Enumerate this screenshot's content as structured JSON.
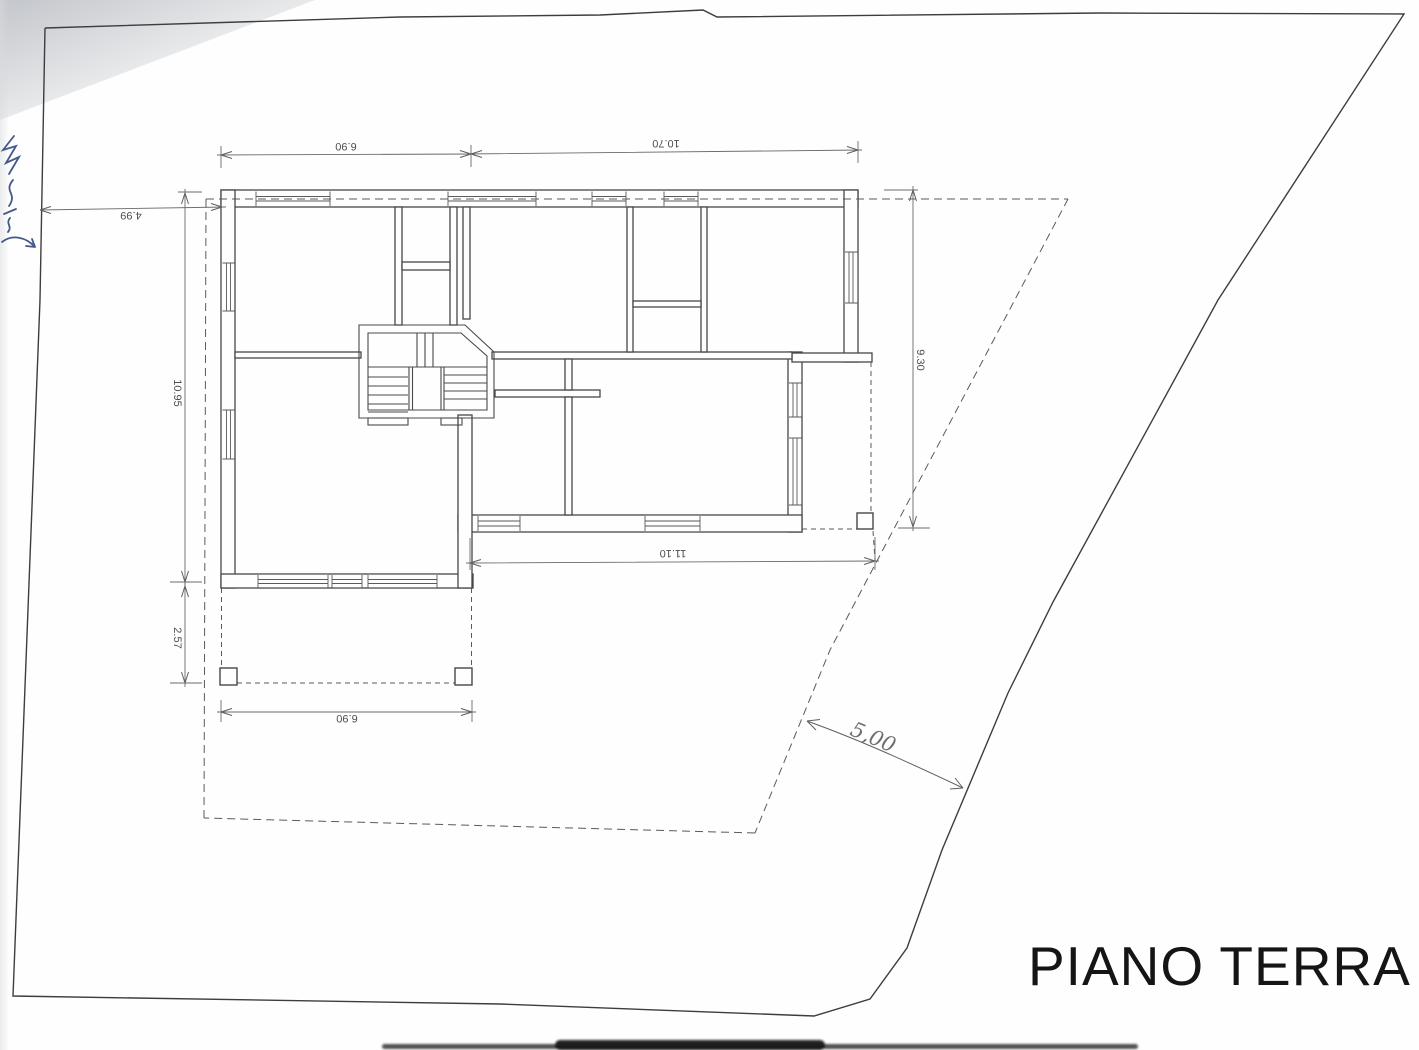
{
  "drawing": {
    "title": "PIANO TERRA"
  },
  "dimensions": {
    "top_left_width": "6.90",
    "top_right_width": "10.70",
    "boundary_to_building": "4.99",
    "left_height": "10.95",
    "porch_depth": "2.57",
    "right_height": "9.30",
    "bottom_width": "11.10",
    "porch_width": "6.90",
    "setback_handwritten": "5,00"
  },
  "annotations": {
    "handwritten_note": "illegible blue handwriting, cut off at left page edge"
  },
  "colors": {
    "ink": "#474747",
    "dim_ink": "#4f4f4f",
    "handwriting_blue": "#44598b",
    "paper": "#fefefe",
    "scan_shadow": "#c3c6cb",
    "page_edge_band": "#161616"
  }
}
